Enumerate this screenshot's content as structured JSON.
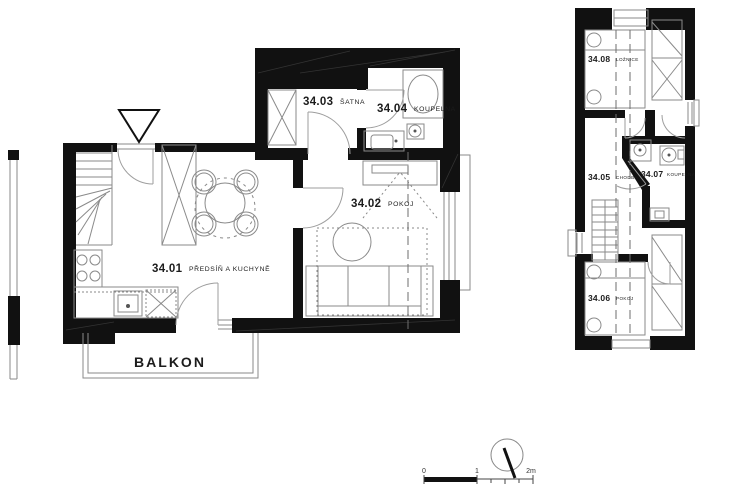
{
  "plans": {
    "ground": {
      "rooms": [
        {
          "number": "34.01",
          "name": "PŘEDSÍŇ A KUCHYNĚ"
        },
        {
          "number": "34.02",
          "name": "POKOJ"
        },
        {
          "number": "34.03",
          "name": "ŠATNA"
        },
        {
          "number": "34.04",
          "name": "KOUPELNA"
        }
      ],
      "balcony_label": "BALKON"
    },
    "upper": {
      "rooms": [
        {
          "number": "34.05",
          "name": "CHODBA"
        },
        {
          "number": "34.06",
          "name": "POKOJ"
        },
        {
          "number": "34.07",
          "name": "KOUPELNA"
        },
        {
          "number": "34.08",
          "name": "LOŽNICE"
        }
      ]
    }
  },
  "scale_bar": {
    "tick0": "0",
    "tick1": "1",
    "tick2": "2m"
  },
  "icons": {
    "compass": "north-needle-icon",
    "section_marker": "triangle-section-marker-icon"
  },
  "colors": {
    "wall": "#111111",
    "line": "#8a8a8a",
    "door": "#9e9e9e",
    "dash": "#6e6e6e",
    "text": "#1c1c1c"
  }
}
